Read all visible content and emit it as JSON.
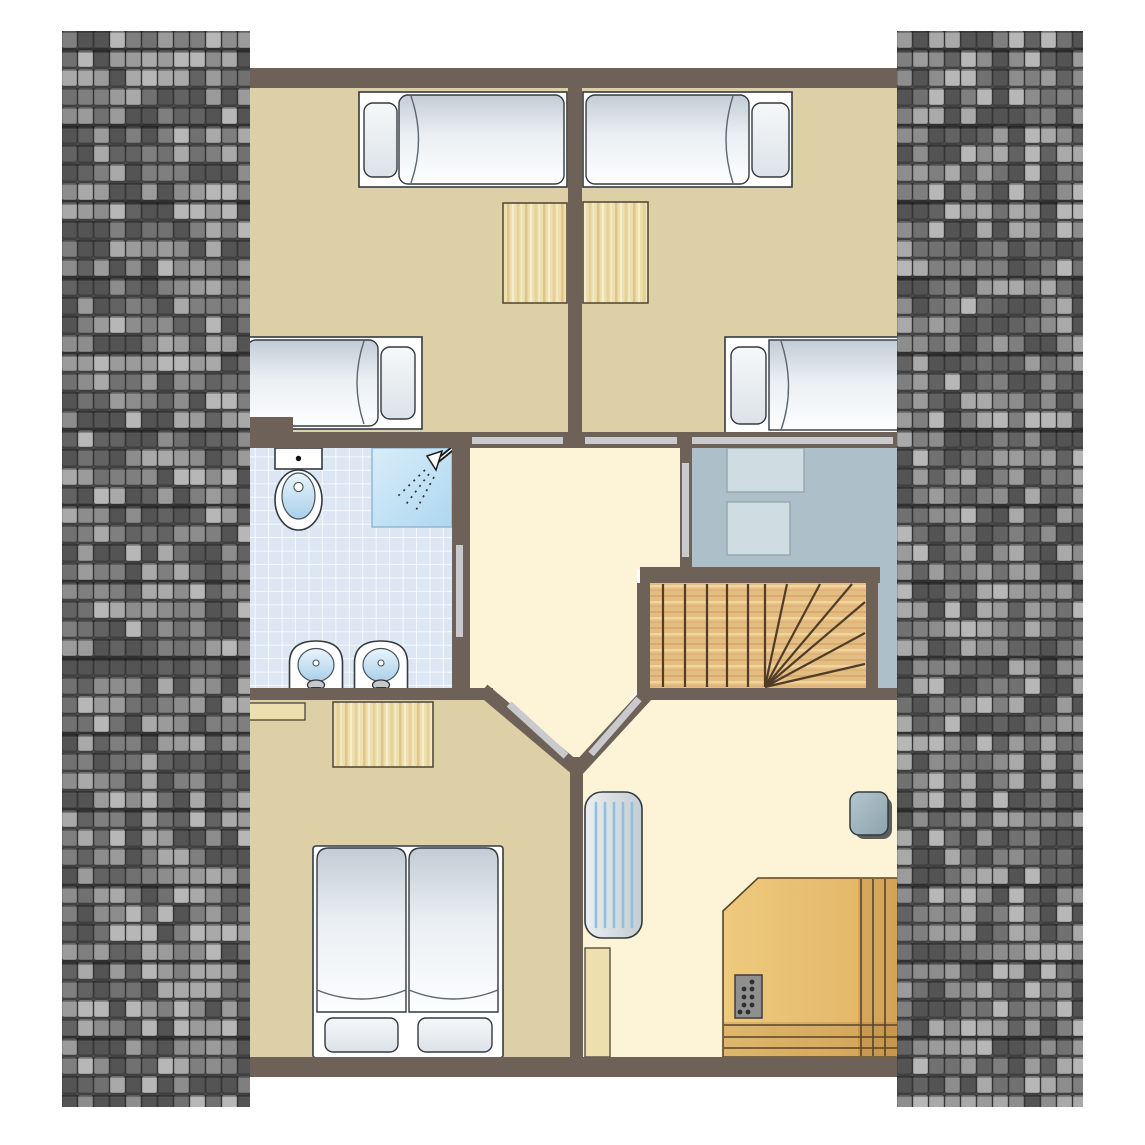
{
  "canvas": {
    "width": 1145,
    "height": 1145,
    "background": "#ffffff"
  },
  "colors": {
    "wall": "#6e6157",
    "outline": "#333a40",
    "floor_tan": "#ddd0a6",
    "floor_cream": "#fdf4d7",
    "bath_tile": "#dce7f3",
    "bath_grid": "#ffffff",
    "gray_floor": "#adbfc8",
    "cabinet": "#cfdce2",
    "cabinet_border": "#97a9b4",
    "door": "#c9cacd",
    "bed_frame": "#ffffff",
    "mattress_top": "#c2ccd6",
    "mattress_mid": "#eaeff3",
    "mattress_bottom": "#fdfeff",
    "pillow_top": "#f5f8fa",
    "pillow_bottom": "#dce2e7",
    "duvet_line": "#5c6670",
    "wood_base": "#eee0ae",
    "wood_grain": "#dcc488",
    "wood_grain_light": "#f7eccb",
    "wood_outline": "#4b4335",
    "stair_base": "#e4bd82",
    "stair_grain": "#d3a767",
    "stair_grain_light": "#f0d49c",
    "stair_line": "#503c29",
    "sauna_base": "#eeca7e",
    "sauna_base2": "#e0b264",
    "sauna_shade": "rgba(150,95,35,0.18)",
    "sauna_line": "#5a4426",
    "stove": "#8f8f8f",
    "stove_border": "#3c3c3c",
    "stove_dot": "#2e2e2e",
    "shower_light": "#d8edf9",
    "shower_dark": "#aed7f0",
    "shower_border": "#8fb9d4",
    "fixture_white": "#ffffff",
    "basin_light": "#e9f4fb",
    "basin_dark": "#a9d0ea",
    "basin_border": "#47525a",
    "radiator_light": "#eaeeef",
    "radiator_dark": "#c3cdd3",
    "radiator_stripe": "#8fc0dd",
    "stool_light": "#b6c6cd",
    "stool_dark": "#8ba3ad",
    "shadow": "#5d5d5d",
    "roof_base": "#4a4a4a",
    "roof_batten": "rgba(0,0,0,0.25)"
  },
  "roof": {
    "seed": 13,
    "tile_width": 16,
    "tile_height": 19,
    "batten_every": 4,
    "palette": [
      "#b7b7b7",
      "#a9a9a9",
      "#9b9b9b",
      "#8d8d8d",
      "#7f7f7f",
      "#717171",
      "#636363",
      "#545454"
    ],
    "left": {
      "x": 62,
      "y": 31,
      "w": 188,
      "h": 1076
    },
    "right": {
      "x": 897,
      "y": 31,
      "w": 186,
      "h": 1076
    }
  },
  "plan": {
    "type": "floor-plan",
    "storey": "attic",
    "rooms": [
      {
        "id": "bedroom-top-left",
        "furniture": [
          "single-bed",
          "single-bed",
          "desk"
        ]
      },
      {
        "id": "bedroom-top-right",
        "furniture": [
          "single-bed",
          "single-bed",
          "desk"
        ]
      },
      {
        "id": "bathroom",
        "furniture": [
          "toilet",
          "shower",
          "washbasin",
          "washbasin"
        ]
      },
      {
        "id": "hallway",
        "furniture": []
      },
      {
        "id": "dressing-room",
        "furniture": [
          "cabinet",
          "cabinet"
        ]
      },
      {
        "id": "staircase",
        "furniture": [
          "winder-stairs"
        ]
      },
      {
        "id": "bedroom-bottom-left",
        "furniture": [
          "double-bed",
          "desk",
          "shelf"
        ]
      },
      {
        "id": "sauna-room",
        "furniture": [
          "radiator",
          "stool",
          "wood-board",
          "sauna",
          "sauna-stove"
        ]
      }
    ],
    "doors": 7
  }
}
